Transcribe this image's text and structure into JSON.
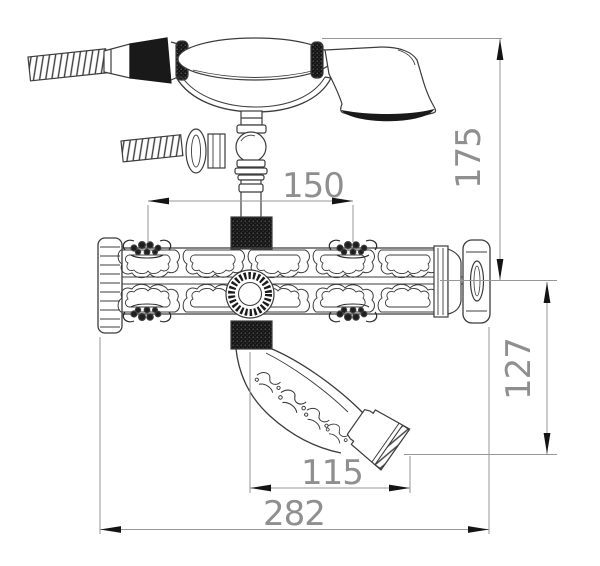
{
  "page": {
    "background": "#ffffff",
    "line_color": "#3c3c3c",
    "dimension_line_color": "#979797",
    "arrow_color": "#141414",
    "text_color": "#8f8f8f"
  },
  "drawing": {
    "type": "technical-dimension-drawing",
    "subject": "wall-mount bathtub mixer faucet with hand shower, curved spout and ornate body",
    "dimensions": [
      {
        "id": "inlet-spacing",
        "value": "150",
        "orientation": "horizontal"
      },
      {
        "id": "height-above-center",
        "value": "175",
        "orientation": "vertical"
      },
      {
        "id": "spout-drop",
        "value": "127",
        "orientation": "vertical"
      },
      {
        "id": "spout-reach",
        "value": "115",
        "orientation": "horizontal"
      },
      {
        "id": "overall-length",
        "value": "282",
        "orientation": "horizontal"
      }
    ]
  }
}
